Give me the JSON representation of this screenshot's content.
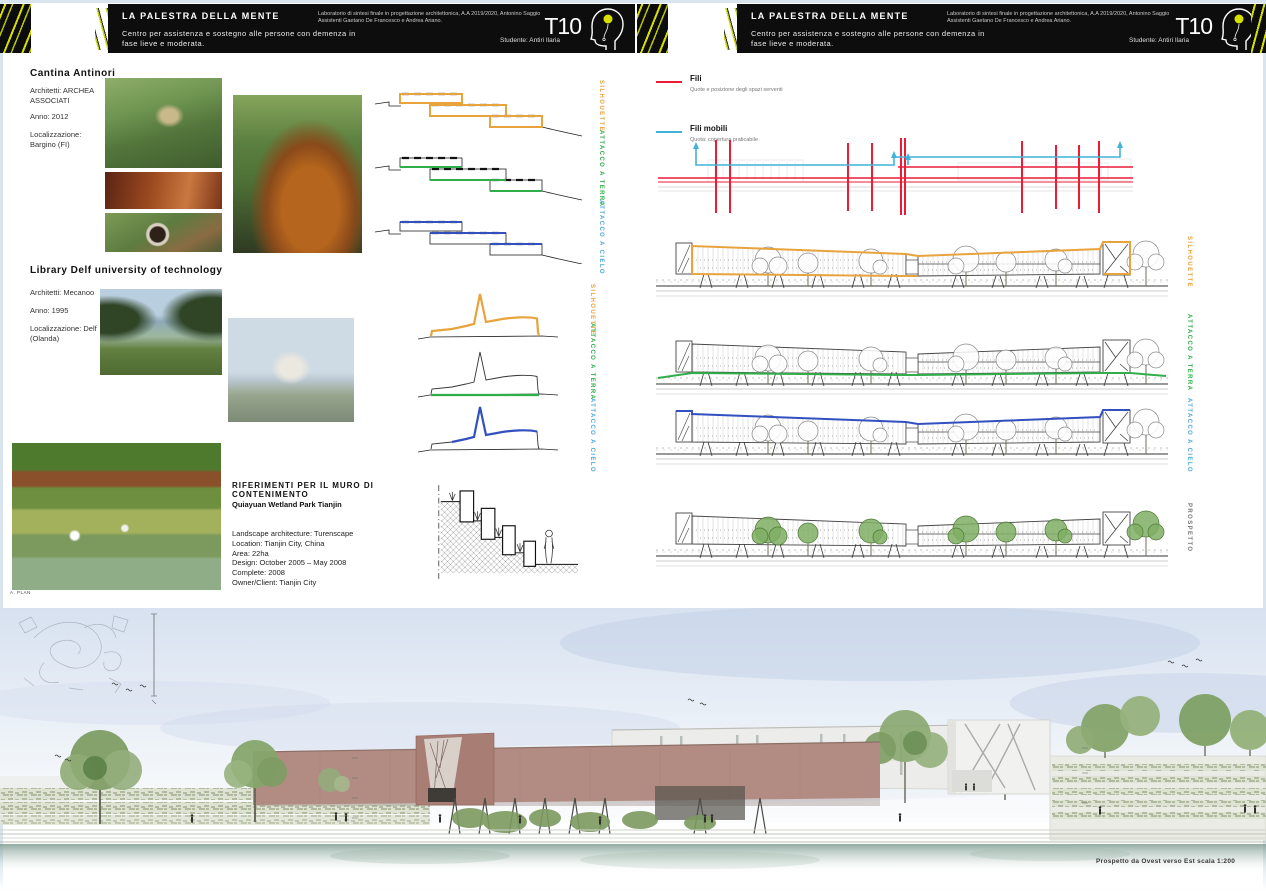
{
  "header": {
    "title": "LA PALESTRA DELLA MENTE",
    "subtitle": "Centro per assistenza e sostegno alle persone con demenza in fase lieve e moderata.",
    "credits": "Laboratorio di sintesi finale in progettazione architettonica, A.A 2019/2020, Antonino Saggio Assistenti Gaetano De Francesco e Andrea Ariano.",
    "student_label": "Studente:",
    "student_name": "Antiri Ilaria",
    "logo_text": "T10"
  },
  "left_panel": {
    "cantina": {
      "title": "Cantina Antinori",
      "architects": "Architetti: ARCHEA ASSOCIATI",
      "year": "Anno: 2012",
      "location": "Localizzazione: Bargino (FI)"
    },
    "library": {
      "title": "Library Delf university of technology",
      "architects": "Architetti: Mecanoo",
      "year": "Anno: 1995",
      "location": "Localizzazione: Delf (Olanda)"
    },
    "riferimenti": {
      "title": "RIFERIMENTI PER IL MURO DI CONTENIMENTO",
      "project": "Quiayuan Wetland Park Tianjin",
      "details": [
        "Landscape architecture: Turenscape",
        "Location: Tianjin City, China",
        "Area: 22ha",
        "Design: October 2005 – May 2008",
        "Complete: 2008",
        "Owner/Client: Tianjin City"
      ]
    },
    "plan_label": "A. PLAN",
    "section_labels": [
      "SILHOUETTE",
      "ATTACCO A TERRA",
      "ATTACCO A CIELO"
    ]
  },
  "right_panel": {
    "legend": [
      {
        "label": "Fili",
        "desc": "Quote e posizione degli spazi serventi",
        "color": "#EC1B36"
      },
      {
        "label": "Fili mobili",
        "desc": "Quota: copertura praticabile",
        "color": "#3FB3D9"
      }
    ],
    "row_labels": [
      "SILHOUETTE",
      "ATTACCO A TERRA",
      "ATTACCO A CIELO",
      "PROSPETTO"
    ]
  },
  "footer": {
    "caption": "Prospetto  da Ovest verso Est scala 1:200"
  },
  "colors": {
    "accent_orange": "#E8A33D",
    "accent_green": "#2FAE49",
    "accent_blue": "#3350C0",
    "label_blue": "#4FA8D8",
    "legend_red": "#EC1B36",
    "legend_cyan": "#3FB3D9",
    "rose_building": "#B08A80"
  }
}
